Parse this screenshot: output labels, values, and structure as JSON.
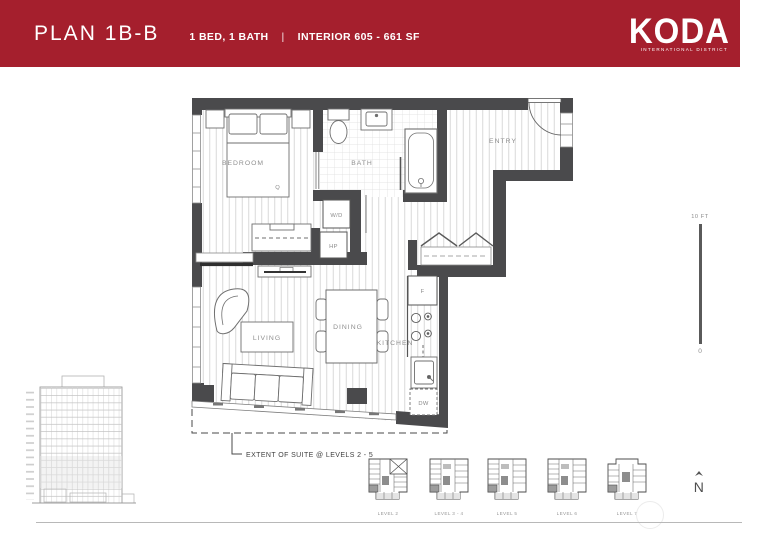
{
  "header": {
    "title": "PLAN 1B-B",
    "specs_left": "1 BED, 1 BATH",
    "divider": "|",
    "specs_right": "INTERIOR 605 - 661 SF",
    "brand": {
      "name": "KODA",
      "tagline": "INTERNATIONAL DISTRICT"
    },
    "bg_color": "#A51F2D"
  },
  "floor_plan": {
    "rooms": {
      "bedroom": "BEDROOM",
      "bath": "BATH",
      "entry": "ENTRY",
      "living": "LIVING",
      "dining": "DINING",
      "kitchen": "KITCHEN"
    },
    "fixtures": {
      "queen_bed": "Q",
      "washer_dryer": "W/D",
      "heat_pump": "HP",
      "fridge": "F",
      "dishwasher": "DW"
    },
    "note": "EXTENT OF SUITE @ LEVELS 2 - 5"
  },
  "scale_bar": {
    "top": "10 FT",
    "bottom": "0"
  },
  "compass": {
    "north": "N"
  },
  "key_plans": {
    "labels": [
      "LEVEL 2",
      "LEVEL 3 - 4",
      "LEVEL 5",
      "LEVEL 6",
      "LEVEL 7"
    ]
  },
  "colors": {
    "header_red": "#A51F2D",
    "wall_gray": "#4A4A4C",
    "label_gray": "#8f8f8f"
  }
}
